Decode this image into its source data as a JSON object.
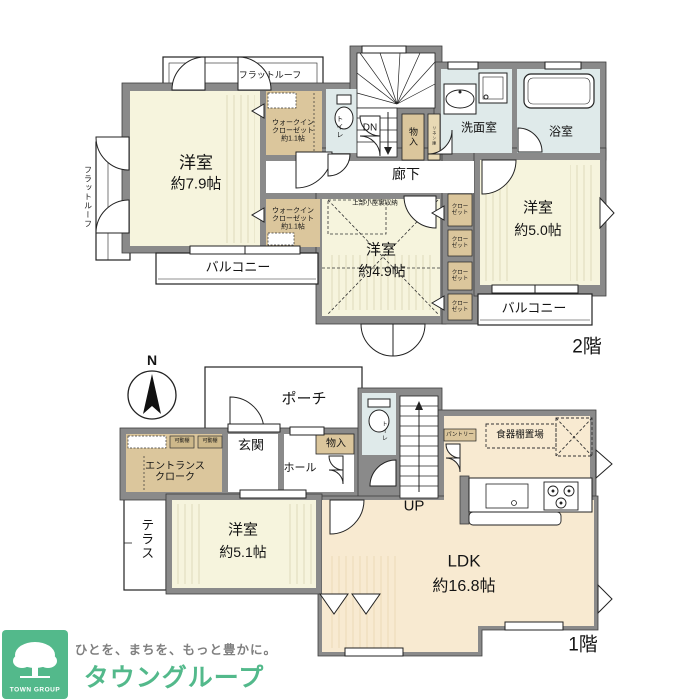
{
  "floor2": {
    "label": "2階",
    "flat_roof_top": "フラットルーフ",
    "flat_roof_left": "フラットルーフ",
    "room_79_name": "洋室",
    "room_79_size": "約7.9帖",
    "wic_line1": "ウォークイン",
    "wic_line2": "クローゼット",
    "wic_line3": "約1.1帖",
    "toilet": "トイレ",
    "stairs_down": "DN",
    "storage": "物入",
    "linen": "リネン庫",
    "washroom": "洗面室",
    "bathroom": "浴室",
    "corridor": "廊下",
    "attic_note": "上部小屋裏収納",
    "room_49_name": "洋室",
    "room_49_size": "約4.9帖",
    "room_50_name": "洋室",
    "room_50_size": "約5.0帖",
    "closet_line1": "クロー",
    "closet_line2": "ゼット",
    "balcony_left": "バルコニー",
    "balcony_right": "バルコニー"
  },
  "floor1": {
    "label": "1階",
    "compass_north": "N",
    "porch": "ポーチ",
    "entrance": "玄関",
    "hall": "ホール",
    "storage": "物入",
    "toilet": "トイレ",
    "cloak_line1": "エントランス",
    "cloak_line2": "クローク",
    "shelf": "可動棚",
    "terrace": "テラス",
    "room_51_name": "洋室",
    "room_51_size": "約5.1帖",
    "stairs_up": "UP",
    "pantry": "パントリー",
    "cupboard_area": "食器棚置場",
    "ldk_name": "LDK",
    "ldk_size": "約16.8帖"
  },
  "logo": {
    "tagline": "ひとを、まちを、もっと豊かに。",
    "brand": "タウングループ",
    "brand_en": "TOWN GROUP"
  },
  "colors": {
    "wall": "#8a8a8a",
    "room_cream": "#f6f4dd",
    "ldk_peach": "#f8ead1",
    "wet_blue": "#dfeaea",
    "closet_tan": "#dbc69c",
    "brand_green": "#53b98b",
    "tagline_gray": "#7f7f7f"
  }
}
